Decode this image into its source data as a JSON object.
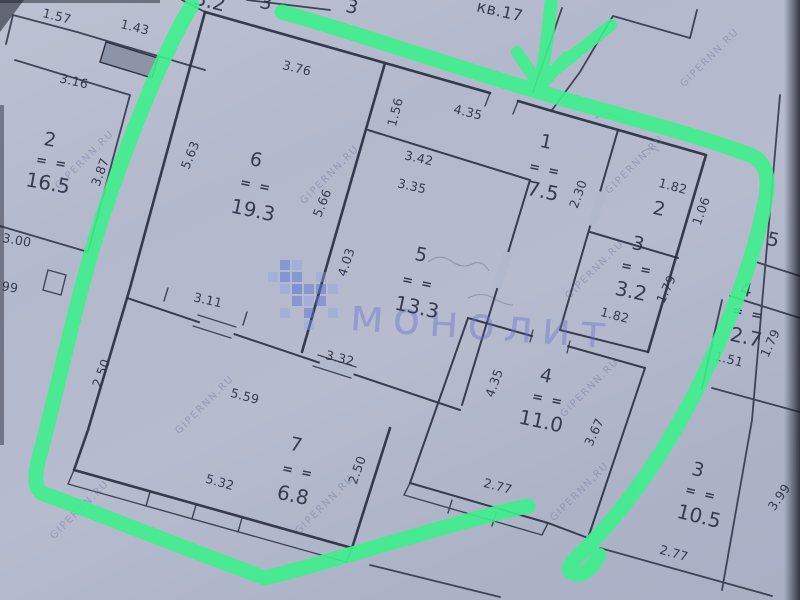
{
  "header": {
    "apartment_label": "кв.17"
  },
  "marks": {
    "area_underline": "= ="
  },
  "watermarks": {
    "site": "GIPERNN.RU",
    "agency": "монолит"
  },
  "rooms": {
    "r1": {
      "number": "1",
      "area": "7.5"
    },
    "r2": {
      "number": "2"
    },
    "r3": {
      "number": "3",
      "area": "3.2"
    },
    "r4": {
      "number": "4",
      "area": "11.0"
    },
    "r5": {
      "number": "5",
      "area": "13.3"
    },
    "r6": {
      "number": "6",
      "area": "19.3"
    },
    "r7": {
      "number": "7",
      "area": "6.8"
    }
  },
  "neighbors": {
    "left2": {
      "number": "2",
      "area": "16.5"
    },
    "right5": {
      "number": "5"
    },
    "right4": {
      "number": "4",
      "area": "2.7"
    },
    "right3": {
      "number": "3",
      "area": "10.5"
    },
    "top_a": {
      "number": "3"
    },
    "top_b": {
      "number": "3"
    },
    "topleft": {
      "area": "3.2"
    }
  },
  "dims": {
    "d157": "1.57",
    "d143": "1.43",
    "d316": "3.16",
    "d376": "3.76",
    "d156": "1.56",
    "d435a": "4.35",
    "d387": "3.87",
    "d563": "5.63",
    "d566": "5.66",
    "d230": "2.30",
    "d342": "3.42",
    "d335": "3.35",
    "d182a": "1.82",
    "d106": "1.06",
    "d179a": "1.79",
    "d182b": "1.82",
    "d300": "3.00",
    "d99": "99",
    "d311": "3.11",
    "d403": "4.03",
    "d179n": "1.79",
    "d151": "1.51",
    "d250a": "2.50",
    "d559": "5.59",
    "d332": "3.32",
    "d435b": "4.35",
    "d367": "3.67",
    "d277a": "2.77",
    "d250b": "2.50",
    "d532": "5.32",
    "d399": "3.99",
    "d277n": "2.77"
  }
}
